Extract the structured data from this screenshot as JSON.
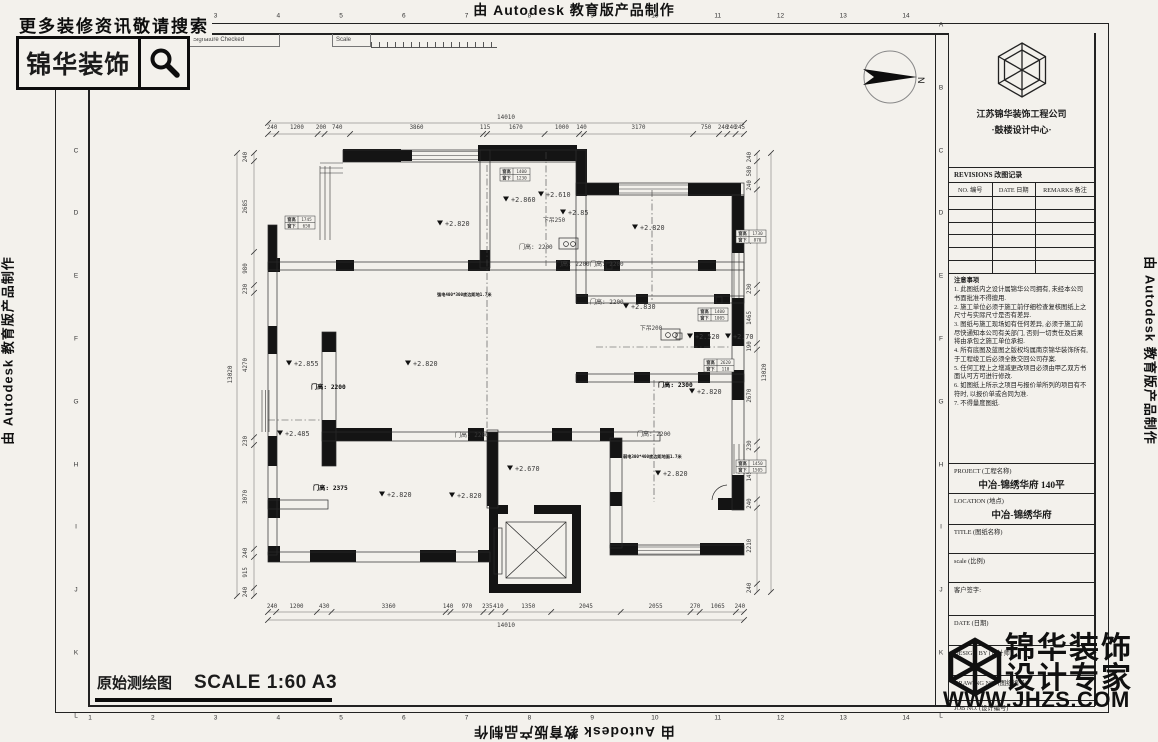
{
  "page": {
    "top_watermark": "由 Autodesk 教育版产品制作",
    "bottom_watermark": "由 Autodesk 教育版产品制作",
    "left_watermark": "由 Autodesk 教育版产品制作",
    "right_watermark": "由 Autodesk 教育版产品制作"
  },
  "promo": {
    "search_text": "更多装修资讯敬请搜索",
    "brand": "锦华装饰",
    "icon": "magnifier-icon"
  },
  "header_strip": {
    "revno": "RevNo",
    "revision_date": "Revision Date",
    "signature_checked": "Signature Checked",
    "scale": "Scale"
  },
  "frame": {
    "grid_numbers": [
      "1",
      "2",
      "3",
      "4",
      "5",
      "6",
      "7",
      "8",
      "9",
      "10",
      "11",
      "12",
      "13",
      "14"
    ],
    "grid_letters": [
      "A",
      "B",
      "C",
      "D",
      "E",
      "F",
      "G",
      "H",
      "I",
      "J",
      "K",
      "L"
    ]
  },
  "plan": {
    "overall_top": "14010",
    "top_dims": [
      "240",
      "1200",
      "200",
      "740",
      "3860",
      "115",
      "1670",
      "1000",
      "140",
      "3170",
      "750",
      "240",
      "240",
      "245"
    ],
    "overall_bottom": "14010",
    "bottom_dims": [
      "240",
      "1200",
      "430",
      "3360",
      "140",
      "970",
      "235",
      "410",
      "1350",
      "2045",
      "2055",
      "270",
      "1065",
      "240"
    ],
    "overall_left": "13020",
    "left_dims": [
      "240",
      "2685",
      "980",
      "230",
      "4270",
      "230",
      "3070",
      "240",
      "915",
      "240"
    ],
    "overall_right": "13020",
    "right_dims": [
      "240",
      "580",
      "240",
      "2770",
      "230",
      "1465",
      "190",
      "2670",
      "230",
      "1450",
      "240",
      "2210",
      "240"
    ],
    "levels": [
      "+2.820",
      "+2.860",
      "+2.610",
      "+2.85",
      "+2.820",
      "+2.830",
      "+2.520",
      "+2.70",
      "+2.855",
      "+2.820",
      "+2.820",
      "+2.485",
      "+2.820",
      "+2.820",
      "+2.670",
      "+2.820"
    ],
    "doors": [
      "门高: 2200",
      "门高: 2200",
      "门高: 2200",
      "门高: 2200",
      "门高: 2200",
      "门高: 2200",
      "门高: 2200",
      "门高: 2300",
      "门高: 2375"
    ],
    "ceilings": [
      "下吊250",
      "下吊200"
    ],
    "window_labels": [
      "窗高",
      "窗下"
    ],
    "window_boxes": [
      {
        "h": "1745",
        "s": "650"
      },
      {
        "h": "1400",
        "s": "1230"
      },
      {
        "h": "1730",
        "s": "870"
      },
      {
        "h": "1400",
        "s": "1005"
      },
      {
        "h": "2620",
        "s": "110"
      },
      {
        "h": "1450",
        "s": "1505"
      }
    ],
    "notes": [
      "强电400*300底边距地1.7米",
      "弱电300*400底边距地面1.7米"
    ],
    "north_label": "N"
  },
  "titleblock": {
    "company": "江苏锦华装饰工程公司",
    "center": "·鼓楼设计中心·",
    "revisions_title": "REVISIONS  改图记录",
    "rev_cols": [
      "NO. 编号",
      "DATE 日期",
      "REMARKS 备注"
    ],
    "notes_title": "注意事项",
    "notes": [
      "1.  此图纸内之设计属锦华公司拥有, 未经本公司书面批准不得擅用.",
      "2.  施工单位必须于施工前仔细检查复核图纸上之尺寸与实际尺寸是否有差异.",
      "3.  图纸与施工现场如有任何差异, 必须于施工前尽快通知本公司有关部门, 否则一切责任及后果将由承包之施工单位承担.",
      "4.  所有底图及蓝图之版权均属南京锦华装饰所有, 于工程竣工后必须全数交回公司存案.",
      "5.  任何工程上之增减更改项目必须由甲乙双方书面认可方可进行修改.",
      "6.  如图纸上所示之项目与报价单所列的项目有不符时, 以报价单或合同为准.",
      "7.  不得量度图纸."
    ],
    "project_label": "PROJECT (工程名称)",
    "project_value": "中冶-锦绣华府  140平",
    "location_label": "LOCATION (地点)",
    "location_value": "中冶-锦绣华府",
    "title_label": "TITLE (图纸名称)",
    "scale_label": "scale   (比例)",
    "sign_label": "客户签字:",
    "date_label": "DATE (日期)",
    "design_by_label": "DESIGN BY (设计师)",
    "drawing_no_label": "DRAWING NO. (图纸编号)",
    "job_no_label": "JOB NO. (设计编号)"
  },
  "sheet": {
    "drawing_title": "原始测绘图",
    "drawing_scale": "SCALE  1:60 A3"
  },
  "watermark": {
    "line1": "锦华装饰",
    "line2": "设计专家",
    "url": "WWW.JHZS.COM"
  }
}
